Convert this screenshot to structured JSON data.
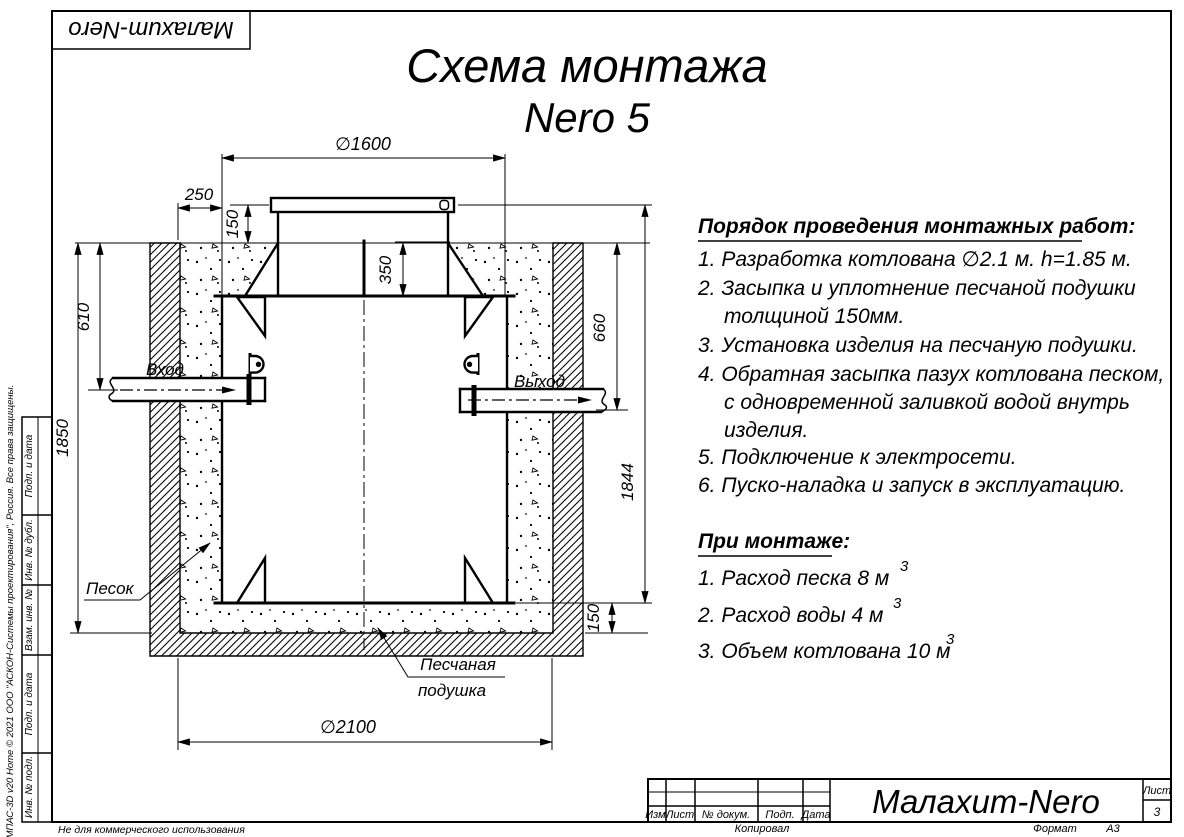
{
  "logo": {
    "text": "Малахит-Nero"
  },
  "title": {
    "line1": "Схема монтажа",
    "line2": "Nero 5"
  },
  "drawing": {
    "dims": {
      "top_diameter": "∅1600",
      "side_gap": "250",
      "neck_height": "150",
      "shoulder_depth": "350",
      "inlet_depth": "610",
      "pit_depth": "1850",
      "outlet_depth": "660",
      "tank_height": "1844",
      "cushion_height": "150",
      "pit_diameter": "∅2100"
    },
    "labels": {
      "inlet": "Вход",
      "outlet": "Выход",
      "sand": "Песок",
      "cushion_line1": "Песчаная",
      "cushion_line2": "подушка"
    }
  },
  "installation": {
    "heading": "Порядок проведения монтажных работ:",
    "lines": [
      "1. Разработка котлована ∅2.1 м. h=1.85 м.",
      "2. Засыпка и уплотнение песчаной подушки",
      "толщиной 150мм.",
      "3. Установка изделия на песчаную подушки.",
      "4. Обратная засыпка пазух котлована песком,",
      "с одновременной заливкой водой внутрь",
      "изделия.",
      "5. Подключение к электросети.",
      "6. Пуско-наладка и запуск в эксплуатацию."
    ]
  },
  "montage": {
    "heading": "При монтаже:",
    "items": [
      {
        "text": "1. Расход песка 8 м",
        "sup": "3"
      },
      {
        "text": "2. Расход воды 4 м",
        "sup": "3"
      },
      {
        "text": "3. Объем котлована 10 м",
        "sup": "3"
      }
    ]
  },
  "title_block": {
    "cols": [
      "Изм.",
      "Лист",
      "№ докум.",
      "Подп.",
      "Дата"
    ],
    "product": "Малахит-Nero",
    "sheet_label": "Лист",
    "sheet_number": "3",
    "copied_by": "Копировал",
    "format_label": "Формат",
    "format_value": "A3"
  },
  "margin": {
    "stamps": [
      "Подп. и дата",
      "Инв. № дубл.",
      "Взам. инв. №",
      "Подп. и дата",
      "Инв. № подл."
    ],
    "copyright": "КОМПАС-3D v20 Home © 2021 ООО \"АСКОН-Системы проектирования\", Россия. Все права защищены.",
    "notice": "Не для коммерческого использования"
  }
}
